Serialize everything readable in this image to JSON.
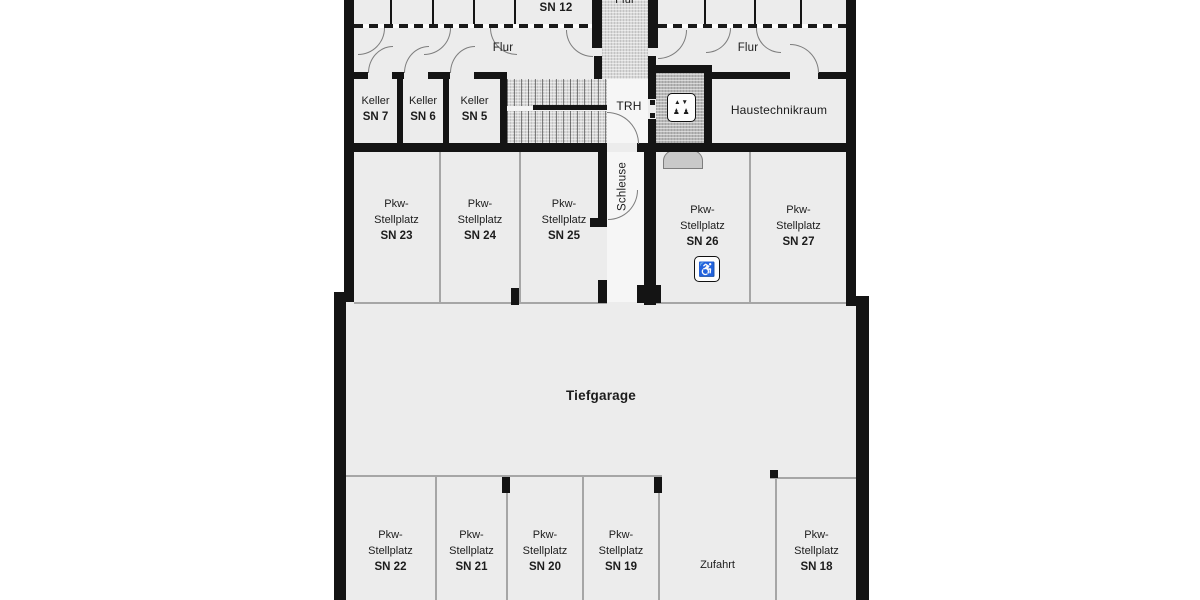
{
  "floorplan": {
    "top_floor_room": {
      "sn": "SN 12"
    },
    "corridors": {
      "flur_center": "Flur",
      "flur_left": "Flur",
      "flur_right": "Flur"
    },
    "stairwell": {
      "label": "TRH"
    },
    "utility_room": {
      "label": "Haustechnikraum"
    },
    "airlock": {
      "label": "Schleuse"
    },
    "garage": {
      "label": "Tiefgarage"
    },
    "driveway": {
      "label": "Zufahrt"
    },
    "cellar_rooms": [
      {
        "type": "Keller",
        "sn": "SN 7"
      },
      {
        "type": "Keller",
        "sn": "SN 6"
      },
      {
        "type": "Keller",
        "sn": "SN 5"
      }
    ],
    "parking_upper": [
      {
        "line1": "Pkw-",
        "line2": "Stellplatz",
        "sn": "SN 23"
      },
      {
        "line1": "Pkw-",
        "line2": "Stellplatz",
        "sn": "SN 24"
      },
      {
        "line1": "Pkw-",
        "line2": "Stellplatz",
        "sn": "SN 25"
      },
      {
        "line1": "Pkw-",
        "line2": "Stellplatz",
        "sn": "SN 26",
        "accessible": true
      },
      {
        "line1": "Pkw-",
        "line2": "Stellplatz",
        "sn": "SN 27"
      }
    ],
    "parking_lower": [
      {
        "line1": "Pkw-",
        "line2": "Stellplatz",
        "sn": "SN 22"
      },
      {
        "line1": "Pkw-",
        "line2": "Stellplatz",
        "sn": "SN 21"
      },
      {
        "line1": "Pkw-",
        "line2": "Stellplatz",
        "sn": "SN 20"
      },
      {
        "line1": "Pkw-",
        "line2": "Stellplatz",
        "sn": "SN 19"
      },
      {
        "line1": "Pkw-",
        "line2": "Stellplatz",
        "sn": "SN 18"
      }
    ],
    "icons": {
      "wheelchair": "♿",
      "elevator_arrows": "▲▼",
      "elevator_people": "♟ ♟"
    },
    "colors": {
      "wall": "#141414",
      "room_fill": "#ececec",
      "light_fill": "#f6f6f6",
      "hatch_fill": "#d8d8d8",
      "shaft_fill": "#b7b7b7",
      "divider": "#a6a6a6"
    }
  }
}
